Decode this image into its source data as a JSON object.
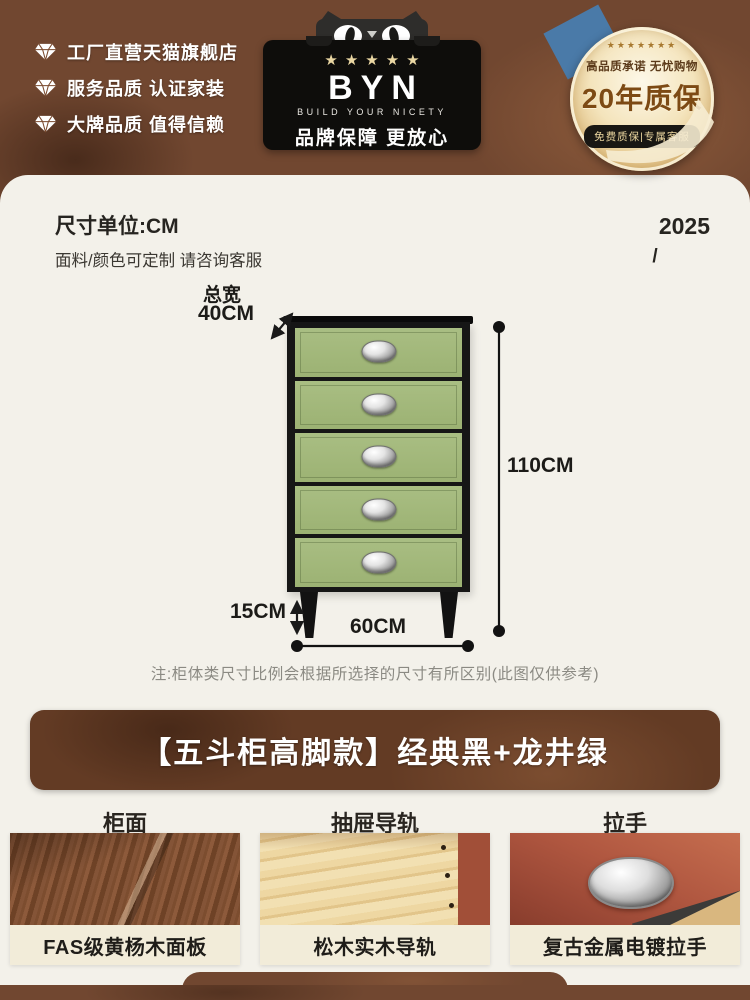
{
  "header": {
    "trust_items": [
      {
        "label": "工厂直营天猫旗舰店"
      },
      {
        "label": "服务品质 认证家装"
      },
      {
        "label": "大牌品质 值得信赖"
      }
    ],
    "brand_badge": {
      "stars": "★★★★★",
      "logo": "BYN",
      "tagline": "BUILD YOUR NICETY",
      "promise": "品牌保障 更放心"
    },
    "medal": {
      "stars": "★★★★★★★",
      "top_line": "高品质承诺 无忧购物",
      "main": "20年质保",
      "pill": "免费质保|专属客服"
    }
  },
  "size_section": {
    "unit_title": "尺寸单位:CM",
    "customize_note": "面料/颜色可定制 请咨询客服",
    "year": "2025",
    "slash": "/",
    "dims": {
      "width_name": "总宽",
      "width_value": "40CM",
      "height": "110CM",
      "leg": "15CM",
      "bottom": "60CM"
    },
    "note": "注:柜体类尺寸比例会根据所选择的尺寸有所区别(此图仅供参考)"
  },
  "product_section": {
    "title": "【五斗柜高脚款】经典黑+龙井绿",
    "features": [
      {
        "header": "柜面",
        "caption": "FAS级黄杨木面板"
      },
      {
        "header": "抽屉导轨",
        "caption": "松木实木导轨"
      },
      {
        "header": "拉手",
        "caption": "复古金属电镀拉手"
      }
    ]
  },
  "colors": {
    "brown": "#714730",
    "brown_dark": "#633b24",
    "cream": "#f3f1ea",
    "green": "#9cb273",
    "gold_star": "#ead7a3",
    "medal_gold": "#e3c489",
    "caption_bg": "#f2ecd9"
  }
}
